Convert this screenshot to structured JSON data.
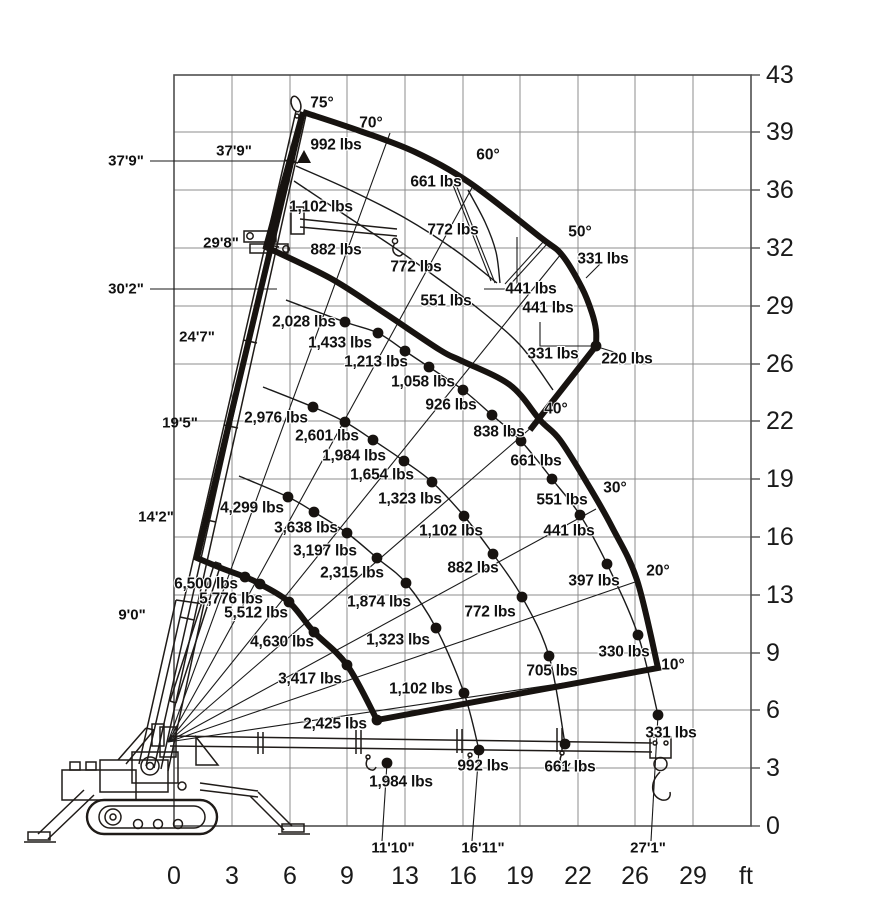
{
  "colors": {
    "ink": "#171310",
    "grid": "#8c8c8c",
    "border": "#4f4f4f",
    "background": "#ffffff"
  },
  "chart_data": {
    "type": "crane_load_chart",
    "x_axis": {
      "unit": "ft",
      "ticks": [
        0,
        3,
        6,
        9,
        13,
        16,
        19,
        22,
        26,
        29
      ]
    },
    "y_axis": {
      "unit": "ft",
      "ticks": [
        43,
        39,
        36,
        32,
        29,
        26,
        22,
        19,
        16,
        13,
        9,
        6,
        3,
        0
      ]
    },
    "boom_angles_deg": [
      75,
      70,
      60,
      50,
      40,
      30,
      20,
      10
    ],
    "boom_section_marks": [
      "9'0\"",
      "14'2\"",
      "19'5\"",
      "24'7\"",
      "29'8\"",
      "37'9\""
    ],
    "tip_height_marks": [
      "37'9\"",
      "30'2\""
    ],
    "ground_radius_marks": [
      "11'10\"",
      "16'11\"",
      "27'1\""
    ],
    "capacities_lbs": {
      "boom_retracted": [
        6500,
        5776,
        5512,
        4630,
        3417,
        2425,
        1984
      ],
      "boom_mid_1": [
        4299,
        3638,
        3197,
        2315,
        1874,
        1323,
        1102,
        992
      ],
      "boom_mid_2": [
        2976,
        2601,
        1984,
        1654,
        1323,
        1102,
        882,
        772,
        705,
        661
      ],
      "boom_full": [
        2028,
        1433,
        1213,
        1058,
        926,
        838,
        661,
        551,
        441,
        397,
        330,
        331
      ],
      "jib_zone": [
        992,
        661,
        1102,
        772,
        882,
        772,
        551,
        441,
        441,
        331,
        331,
        220
      ]
    }
  },
  "axes": {
    "x_label_y": 876,
    "x_unit": {
      "t": "ft",
      "x": 746
    },
    "x_ticks": [
      {
        "t": "0",
        "x": 174
      },
      {
        "t": "3",
        "x": 232
      },
      {
        "t": "6",
        "x": 290
      },
      {
        "t": "9",
        "x": 347
      },
      {
        "t": "13",
        "x": 405
      },
      {
        "t": "16",
        "x": 463
      },
      {
        "t": "19",
        "x": 520
      },
      {
        "t": "22",
        "x": 578
      },
      {
        "t": "26",
        "x": 635
      },
      {
        "t": "29",
        "x": 693
      }
    ],
    "y_label_x": 766,
    "y_ticks": [
      {
        "t": "43",
        "y": 75
      },
      {
        "t": "39",
        "y": 132
      },
      {
        "t": "36",
        "y": 190
      },
      {
        "t": "32",
        "y": 248
      },
      {
        "t": "29",
        "y": 306
      },
      {
        "t": "26",
        "y": 364
      },
      {
        "t": "22",
        "y": 421
      },
      {
        "t": "19",
        "y": 479
      },
      {
        "t": "16",
        "y": 537
      },
      {
        "t": "13",
        "y": 595
      },
      {
        "t": "9",
        "y": 653
      },
      {
        "t": "6",
        "y": 710
      },
      {
        "t": "3",
        "y": 768
      },
      {
        "t": "0",
        "y": 826
      }
    ]
  },
  "labels": {
    "capacities": [
      {
        "t": "992 lbs",
        "x": 336,
        "y": 145
      },
      {
        "t": "661 lbs",
        "x": 436,
        "y": 182
      },
      {
        "t": "1,102 lbs",
        "x": 321,
        "y": 207
      },
      {
        "t": "772 lbs",
        "x": 453,
        "y": 230
      },
      {
        "t": "882 lbs",
        "x": 336,
        "y": 250
      },
      {
        "t": "772 lbs",
        "x": 416,
        "y": 267
      },
      {
        "t": "551 lbs",
        "x": 446,
        "y": 301
      },
      {
        "t": "441 lbs",
        "x": 531,
        "y": 289
      },
      {
        "t": "441 lbs",
        "x": 548,
        "y": 308
      },
      {
        "t": "331 lbs",
        "x": 603,
        "y": 259
      },
      {
        "t": "331 lbs",
        "x": 553,
        "y": 354
      },
      {
        "t": "220 lbs",
        "x": 627,
        "y": 359
      },
      {
        "t": "2,028 lbs",
        "x": 304,
        "y": 322
      },
      {
        "t": "1,433 lbs",
        "x": 340,
        "y": 343
      },
      {
        "t": "1,213 lbs",
        "x": 376,
        "y": 362
      },
      {
        "t": "1,058 lbs",
        "x": 423,
        "y": 382
      },
      {
        "t": "926 lbs",
        "x": 451,
        "y": 405
      },
      {
        "t": "838 lbs",
        "x": 499,
        "y": 432
      },
      {
        "t": "661 lbs",
        "x": 536,
        "y": 461
      },
      {
        "t": "551 lbs",
        "x": 562,
        "y": 500
      },
      {
        "t": "441 lbs",
        "x": 569,
        "y": 531
      },
      {
        "t": "397 lbs",
        "x": 594,
        "y": 581
      },
      {
        "t": "330 lbs",
        "x": 624,
        "y": 652
      },
      {
        "t": "331 lbs",
        "x": 671,
        "y": 733
      },
      {
        "t": "2,976 lbs",
        "x": 276,
        "y": 418
      },
      {
        "t": "2,601 lbs",
        "x": 327,
        "y": 436
      },
      {
        "t": "1,984 lbs",
        "x": 354,
        "y": 456
      },
      {
        "t": "1,654 lbs",
        "x": 382,
        "y": 475
      },
      {
        "t": "1,323 lbs",
        "x": 410,
        "y": 499
      },
      {
        "t": "1,102 lbs",
        "x": 451,
        "y": 531
      },
      {
        "t": "882 lbs",
        "x": 473,
        "y": 568
      },
      {
        "t": "772 lbs",
        "x": 490,
        "y": 612
      },
      {
        "t": "705 lbs",
        "x": 552,
        "y": 671
      },
      {
        "t": "661 lbs",
        "x": 570,
        "y": 767
      },
      {
        "t": "4,299 lbs",
        "x": 252,
        "y": 508
      },
      {
        "t": "3,638 lbs",
        "x": 306,
        "y": 528
      },
      {
        "t": "3,197 lbs",
        "x": 325,
        "y": 551
      },
      {
        "t": "2,315 lbs",
        "x": 352,
        "y": 573
      },
      {
        "t": "1,874 lbs",
        "x": 379,
        "y": 602
      },
      {
        "t": "1,323 lbs",
        "x": 398,
        "y": 640
      },
      {
        "t": "1,102 lbs",
        "x": 421,
        "y": 689
      },
      {
        "t": "992 lbs",
        "x": 483,
        "y": 766
      },
      {
        "t": "6,500 lbs",
        "x": 206,
        "y": 584
      },
      {
        "t": "5,776 lbs",
        "x": 231,
        "y": 599
      },
      {
        "t": "5,512 lbs",
        "x": 256,
        "y": 613
      },
      {
        "t": "4,630 lbs",
        "x": 282,
        "y": 642
      },
      {
        "t": "3,417 lbs",
        "x": 310,
        "y": 679
      },
      {
        "t": "2,425 lbs",
        "x": 335,
        "y": 724
      },
      {
        "t": "1,984 lbs",
        "x": 401,
        "y": 782
      }
    ],
    "angles": [
      {
        "t": "75°",
        "x": 322,
        "y": 103
      },
      {
        "t": "70°",
        "x": 371,
        "y": 123
      },
      {
        "t": "60°",
        "x": 488,
        "y": 155
      },
      {
        "t": "50°",
        "x": 580,
        "y": 232
      },
      {
        "t": "40°",
        "x": 556,
        "y": 409
      },
      {
        "t": "30°",
        "x": 615,
        "y": 488
      },
      {
        "t": "20°",
        "x": 658,
        "y": 571
      },
      {
        "t": "10°",
        "x": 673,
        "y": 665
      }
    ],
    "heights": [
      {
        "t": "37'9\"",
        "x": 126,
        "y": 161
      },
      {
        "t": "30'2\"",
        "x": 126,
        "y": 289
      },
      {
        "t": "24'7\"",
        "x": 197,
        "y": 337
      },
      {
        "t": "19'5\"",
        "x": 180,
        "y": 423
      },
      {
        "t": "14'2\"",
        "x": 156,
        "y": 517
      },
      {
        "t": "9'0\"",
        "x": 132,
        "y": 615
      }
    ],
    "boom_lengths": [
      {
        "t": "37'9\"",
        "x": 234,
        "y": 151
      },
      {
        "t": "29'8\"",
        "x": 221,
        "y": 243
      }
    ],
    "radii": [
      {
        "t": "11'10\"",
        "x": 393,
        "y": 848
      },
      {
        "t": "16'11\"",
        "x": 483,
        "y": 848
      },
      {
        "t": "27'1\"",
        "x": 648,
        "y": 848
      }
    ]
  },
  "geometry": {
    "pivot": [
      168,
      742
    ],
    "grid_x": [
      174,
      232,
      290,
      347,
      405,
      463,
      520,
      578,
      635,
      693,
      751
    ],
    "grid_y": [
      75,
      132,
      190,
      248,
      306,
      364,
      421,
      479,
      537,
      595,
      653,
      710,
      768,
      826
    ],
    "border": {
      "x": 174,
      "y": 75,
      "w": 577,
      "h": 751
    },
    "angle_lines": [
      {
        "deg": "70",
        "end": [
          390,
          133
        ]
      },
      {
        "deg": "60",
        "end": [
          473,
          186
        ]
      },
      {
        "deg": "50",
        "end": [
          561,
          254
        ]
      },
      {
        "deg": "40",
        "end": [
          540,
          420
        ]
      },
      {
        "deg": "30",
        "end": [
          596,
          509
        ]
      },
      {
        "deg": "20",
        "end": [
          638,
          581
        ]
      },
      {
        "deg": "10",
        "end": [
          659,
          669
        ]
      }
    ],
    "envelope_main": [
      {
        "m": [
          303,
          112
        ]
      },
      {
        "l": [
          197,
          558
        ]
      },
      {
        "c": [
          [
            221,
            568
          ],
          [
            245,
            577
          ],
          [
            260,
            584
          ],
          [
            289,
            602
          ],
          [
            314,
            632
          ],
          [
            347,
            665
          ],
          [
            377,
            720
          ]
        ]
      },
      {
        "l": [
          658,
          668
        ]
      },
      {
        "c": [
          [
            637,
            580
          ],
          [
            612,
            527
          ],
          [
            587,
            483
          ],
          [
            560,
            440
          ],
          [
            540,
            420
          ],
          [
            510,
            385
          ],
          [
            462,
            361
          ],
          [
            440,
            350
          ],
          [
            383,
            312
          ],
          [
            330,
            278
          ],
          [
            266,
            247
          ]
        ]
      },
      {
        "z": 1
      }
    ],
    "envelope_jib": [
      {
        "m": [
          303,
          112
        ]
      },
      {
        "c": [
          [
            360,
            131
          ],
          [
            415,
            152
          ],
          [
            470,
            183
          ],
          [
            540,
            237
          ],
          [
            562,
            255
          ],
          [
            582,
            288
          ],
          [
            592,
            313
          ],
          [
            596,
            330
          ],
          [
            596,
            346
          ]
        ]
      },
      {
        "l": [
          530,
          430
        ]
      }
    ],
    "thin_arcs": [
      {
        "name": "arc-boom-2",
        "pts": [
          [
            239,
            476
          ],
          [
            288,
            497
          ],
          [
            314,
            512
          ],
          [
            347,
            533
          ],
          [
            377,
            558
          ],
          [
            406,
            583
          ],
          [
            436,
            628
          ],
          [
            464,
            693
          ],
          [
            479,
            750
          ]
        ]
      },
      {
        "name": "arc-boom-3",
        "pts": [
          [
            263,
            387
          ],
          [
            313,
            407
          ],
          [
            345,
            422
          ],
          [
            373,
            440
          ],
          [
            404,
            461
          ],
          [
            432,
            482
          ],
          [
            464,
            516
          ],
          [
            493,
            554
          ],
          [
            522,
            597
          ],
          [
            549,
            656
          ],
          [
            565,
            744
          ]
        ]
      },
      {
        "name": "arc-boom-4",
        "pts": [
          [
            286,
            300
          ],
          [
            345,
            322
          ],
          [
            378,
            333
          ],
          [
            405,
            351
          ],
          [
            429,
            367
          ],
          [
            463,
            390
          ],
          [
            492,
            415
          ],
          [
            521,
            441
          ],
          [
            552,
            479
          ],
          [
            580,
            515
          ],
          [
            607,
            564
          ],
          [
            638,
            635
          ],
          [
            658,
            715
          ]
        ]
      },
      {
        "name": "arc-jib-1",
        "pts": [
          [
            296,
            166
          ],
          [
            350,
            190
          ],
          [
            405,
            218
          ],
          [
            455,
            250
          ],
          [
            497,
            283
          ]
        ]
      },
      {
        "name": "arc-jib-2",
        "pts": [
          [
            294,
            181
          ],
          [
            345,
            215
          ],
          [
            395,
            248
          ],
          [
            440,
            280
          ],
          [
            480,
            310
          ],
          [
            520,
            345
          ],
          [
            553,
            390
          ]
        ]
      },
      {
        "name": "arc-jib-3",
        "pts": [
          [
            468,
            190
          ],
          [
            485,
            222
          ],
          [
            496,
            252
          ],
          [
            500,
            283
          ]
        ]
      }
    ],
    "aux_lines": [
      [
        [
          150,
          161
        ],
        [
          295,
          161
        ]
      ],
      [
        [
          150,
          289
        ],
        [
          277,
          289
        ]
      ],
      [
        [
          517,
          237
        ],
        [
          517,
          289
        ],
        [
          484,
          289
        ]
      ],
      [
        [
          540,
          322
        ],
        [
          540,
          346
        ],
        [
          593,
          346
        ]
      ],
      [
        [
          451,
          180
        ],
        [
          491,
          281
        ]
      ],
      [
        [
          455,
          182
        ],
        [
          495,
          283
        ]
      ],
      [
        [
          544,
          241
        ],
        [
          505,
          284
        ]
      ],
      [
        [
          547,
          244
        ],
        [
          508,
          287
        ]
      ],
      [
        [
          600,
          264
        ],
        [
          586,
          278
        ]
      ],
      [
        [
          614,
          352
        ],
        [
          601,
          348
        ]
      ]
    ],
    "connectors": [
      [
        [
          387,
          763
        ],
        [
          382,
          841
        ]
      ],
      [
        [
          479,
          750
        ],
        [
          472,
          841
        ]
      ],
      [
        [
          658,
          715
        ],
        [
          651,
          841
        ]
      ]
    ],
    "dots": [
      [
        245,
        577
      ],
      [
        260,
        584
      ],
      [
        289,
        602
      ],
      [
        314,
        632
      ],
      [
        347,
        665
      ],
      [
        377,
        720
      ],
      [
        387,
        763
      ],
      [
        288,
        497
      ],
      [
        314,
        512
      ],
      [
        347,
        533
      ],
      [
        377,
        558
      ],
      [
        406,
        583
      ],
      [
        436,
        628
      ],
      [
        464,
        693
      ],
      [
        479,
        750
      ],
      [
        313,
        407
      ],
      [
        345,
        422
      ],
      [
        373,
        440
      ],
      [
        404,
        461
      ],
      [
        432,
        482
      ],
      [
        464,
        516
      ],
      [
        493,
        554
      ],
      [
        522,
        597
      ],
      [
        549,
        656
      ],
      [
        565,
        744
      ],
      [
        345,
        322
      ],
      [
        378,
        333
      ],
      [
        405,
        351
      ],
      [
        429,
        367
      ],
      [
        463,
        390
      ],
      [
        492,
        415
      ],
      [
        521,
        441
      ],
      [
        552,
        479
      ],
      [
        580,
        515
      ],
      [
        607,
        564
      ],
      [
        638,
        635
      ],
      [
        658,
        715
      ],
      [
        596,
        346
      ]
    ],
    "triangle": [
      304,
      157
    ]
  }
}
